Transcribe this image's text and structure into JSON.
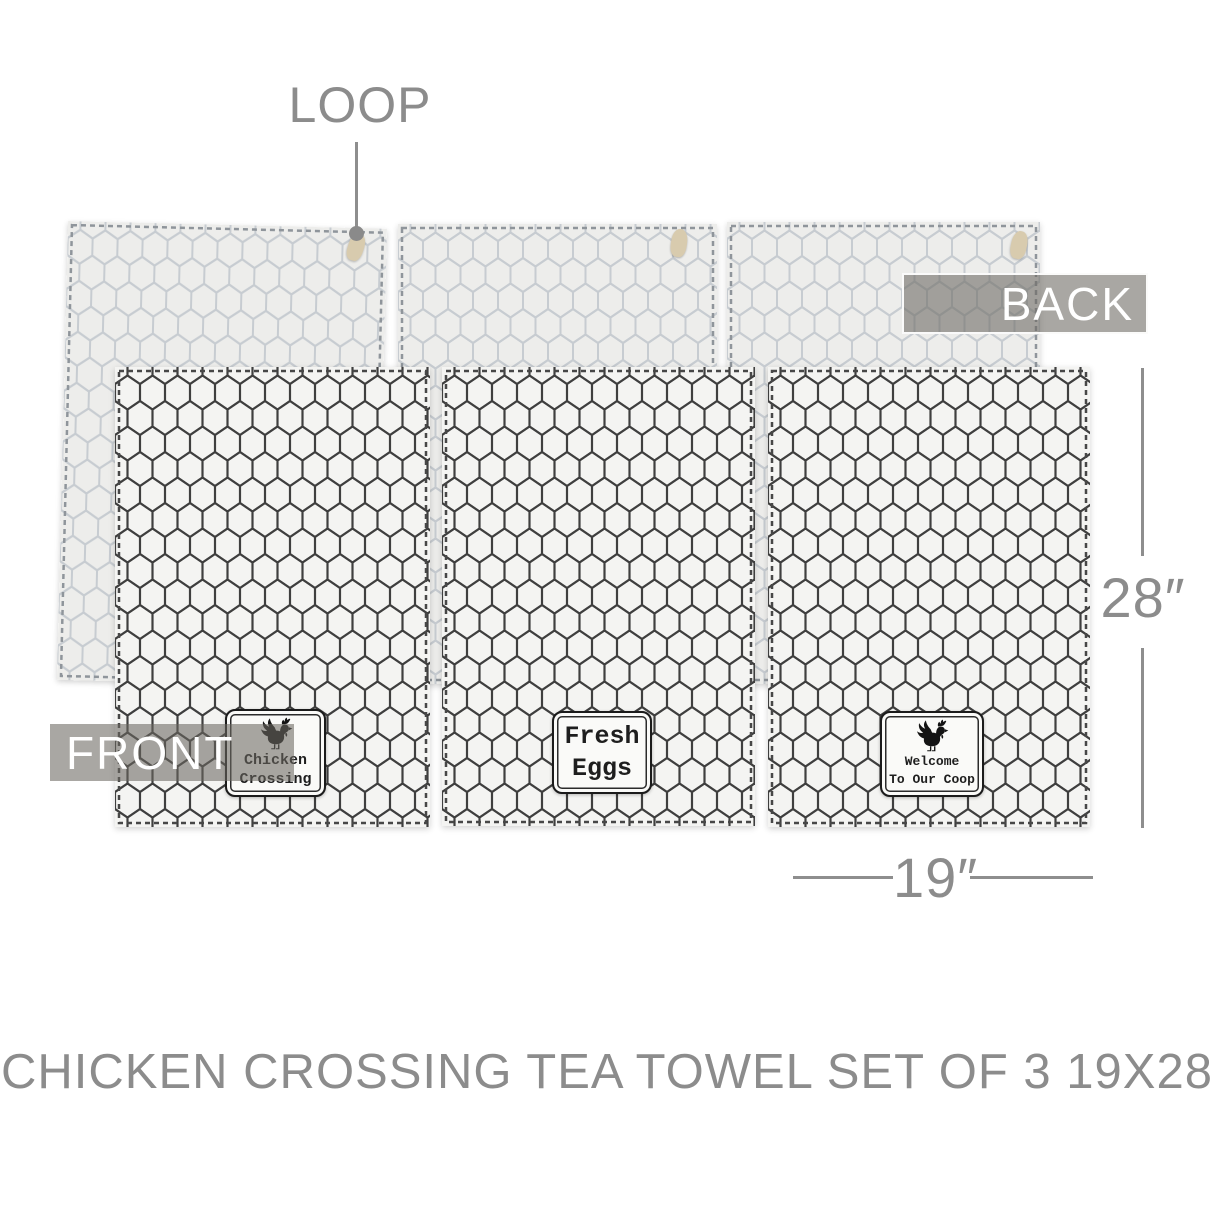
{
  "title": "CHICKEN CROSSING TEA TOWEL SET OF 3 19X28",
  "labels": {
    "loop": "LOOP",
    "back": "BACK",
    "front": "FRONT"
  },
  "dimensions": {
    "height": "28″",
    "width": "19″"
  },
  "badges": [
    {
      "icon": "rooster",
      "lines": [
        "Chicken",
        "Crossing"
      ]
    },
    {
      "icon": "",
      "lines": [
        "Fresh",
        "Eggs"
      ]
    },
    {
      "icon": "rooster",
      "lines": [
        "Welcome",
        "To Our Coop"
      ]
    }
  ],
  "colors": {
    "annotation_gray": "#8c8c8c",
    "overlay_bar_gray": "rgba(106,104,97,0.58)",
    "front_pattern_ink": "#3f3f3f",
    "back_pattern_ink": "#c7ccd1",
    "front_towel_bg": "#f4f4f2",
    "back_towel_bg": "#ededeb",
    "loop_tan": "#d8cbae",
    "badge_ink": "#1e1e1e"
  }
}
